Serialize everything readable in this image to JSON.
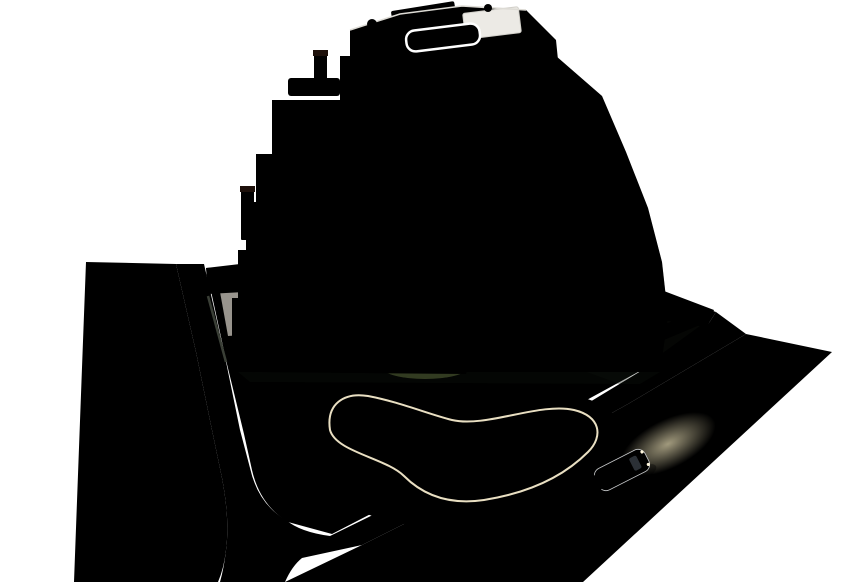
{
  "scene": {
    "title": "Aerial dusk render of a stepped modern apartment building with landscaped pool garden, perimeter bike path, roads and a passing car",
    "objects": {
      "building": "apartment-building",
      "rooftop_pool": "rooftop-plunge-pool",
      "solar_structure": "rooftop-solar-panel",
      "balcony_bands": "white-curved-balcony-bands",
      "communal_pool": "lagoon-shaped-pool",
      "pool_deck": "sand-colored-pool-deck",
      "parasols": "dark-red-parasols",
      "loungers": "sun-loungers",
      "hedge": "perimeter-hedge",
      "lawn": "garden-lawn",
      "flower_bed": "yellow-flower-bed",
      "palms": "palm-trees",
      "bike_path": "red-bike-path",
      "road_left": "asphalt-road-left",
      "road_right": "asphalt-road-right",
      "sidewalk": "corner-sidewalk",
      "walls": "white-perimeter-walls",
      "car": "white-car-with-headlights-on"
    },
    "counts": {
      "visible_stories": 7,
      "balcony_bands": 7,
      "palm_trees": 10,
      "parasols": 4,
      "chimneys": 3,
      "pools": 2,
      "cars": 1
    }
  },
  "colors": {
    "background": "#ffffff",
    "asphalt": "#33373b",
    "asphalt_dark": "#2b2f33",
    "bike_path": "#8c4f45",
    "bike_path_dark": "#7a4238",
    "curb": "#b9b2a4",
    "sidewalk": "#cfc7b6",
    "hedge": "#2b3e21",
    "shrub": "#33451f",
    "lawn_light": "#7d8648",
    "lawn_dark": "#45502c",
    "deck_light": "#e6d6ae",
    "deck_dark": "#c2ae85",
    "pool_light": "#c2ebe2",
    "pool_dark": "#74bdb4",
    "pool_glow": "#fff6d8",
    "facade": "#4a382c",
    "facade_side": "#342720",
    "band_white": "#f6f5f1",
    "band_shadow": "#d8d5cf",
    "window_dark": "#211f26",
    "window_lit": "#ecca8d",
    "window_pale": "#c6cfd4",
    "terrace_gray": "#b0aeaa",
    "terrace_dark": "#8f8d89",
    "wall_white": "#f3f2ee",
    "chimney": "#3f2318",
    "furniture": "#35353b",
    "palm_light": "#8fa04b",
    "palm_dark": "#55682e",
    "trunk": "#6b5234",
    "flower_yellow": "#d9b73a",
    "umbrella": "#7c3a2c",
    "lounger": "#e9e3d3",
    "car_body": "#e7e9eb",
    "car_glass": "#23262b",
    "car_taillight": "#ff2d24",
    "headlight_glow": "#f7ecc0",
    "roof_pool": "#b9e2e1",
    "solar_panel": "#221f1b"
  }
}
